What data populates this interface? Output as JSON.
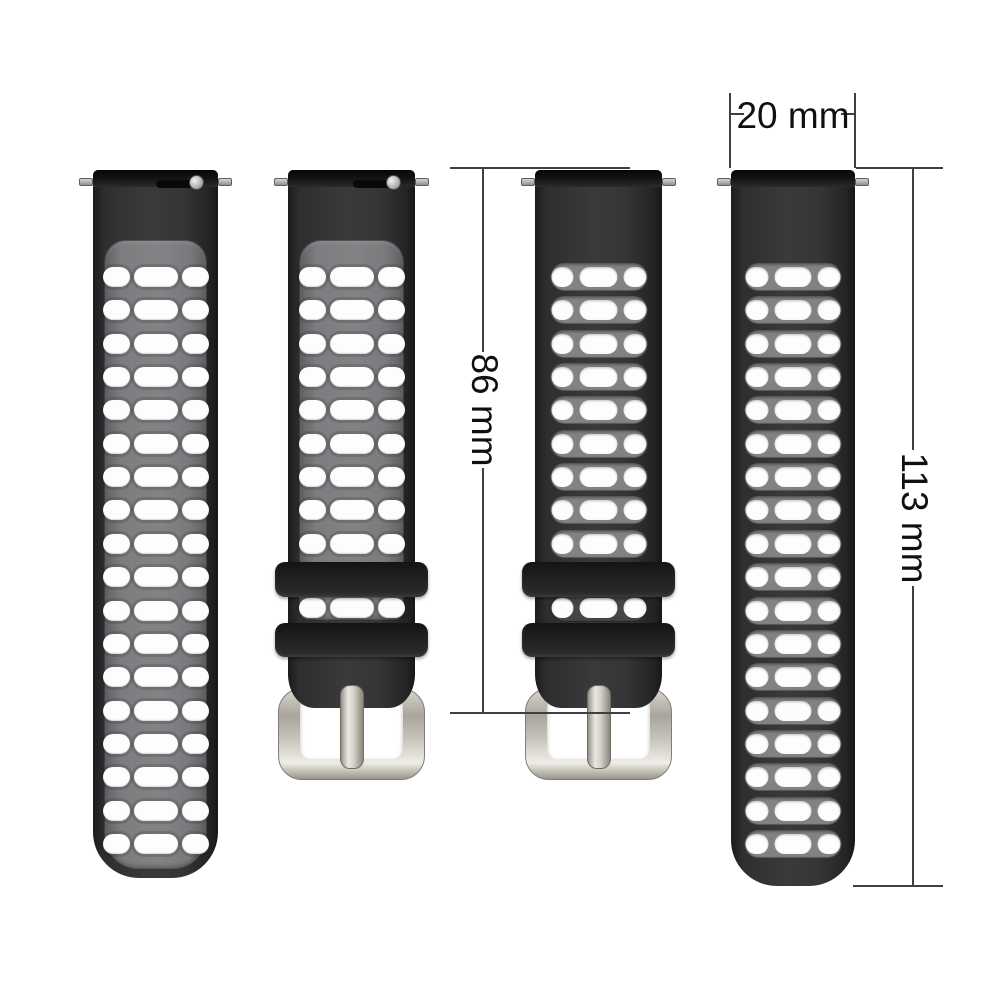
{
  "title": "Silicone watch band set with dimension measurements",
  "background": "#ffffff",
  "annotation": {
    "line_color": "#3f3f3f",
    "text_color": "#101010"
  },
  "dimensions": {
    "strap_width": {
      "label": "20 mm"
    },
    "buckle_strap_length": {
      "label": "86 mm"
    },
    "long_strap_length": {
      "label": "113 mm"
    }
  },
  "colors": {
    "strap_black": "#323234",
    "lug_bar_black": "#141416",
    "inner_panel_gray": "#7d7d80",
    "vent_band_gray": "#828285",
    "vent_hole_white": "#fdfdfd",
    "keeper_black": "#1d1d1f",
    "buckle_silver": "#c9c5bc",
    "spring_bar_pin_silver": "#b9b9b9"
  },
  "straps": [
    {
      "name": "long-strap-two-tone",
      "variant": "two-tone",
      "kind": "long",
      "x": 93,
      "width": 125,
      "height": 708,
      "rows": 18,
      "quick_release": true
    },
    {
      "name": "buckle-strap-two-tone",
      "variant": "two-tone",
      "kind": "buckle",
      "x": 288,
      "width": 127,
      "rows": 9,
      "quick_release": true
    },
    {
      "name": "buckle-strap-black",
      "variant": "black",
      "kind": "buckle",
      "x": 535,
      "width": 127,
      "rows": 9,
      "quick_release": false
    },
    {
      "name": "long-strap-black",
      "variant": "black",
      "kind": "long",
      "x": 731,
      "width": 124,
      "height": 716,
      "rows": 18,
      "quick_release": false
    }
  ]
}
